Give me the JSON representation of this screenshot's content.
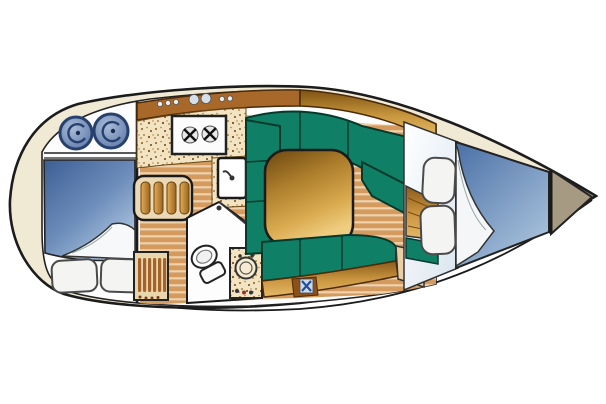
{
  "palette": {
    "page_bg": "#ffffff",
    "hull_outline": "#1c1c1c",
    "deck_cream": "#f0e9d4",
    "cabin_white": "#fdfdfd",
    "upholstery_green": "#0f8066",
    "upholstery_green_dark": "#06382c",
    "wood_gold": "#c8943e",
    "wood_brown": "#8a5a1a",
    "galley_strip_brown": "#a8682a",
    "counter_base": "#f2e4c2",
    "floor_tan": "#d59a5e",
    "floor_light": "#efd2ab",
    "berth_blue": "#4a70a6",
    "berth_blue_light": "#b6cbe2",
    "anchor_locker_taupe": "#a79a83",
    "louver_tan": "#e9d6ac",
    "louver_slat": "#a3632a",
    "fixture_blue": "#5b76a6",
    "fixture_navy": "#27406e",
    "pillow_white": "#f4f4f2",
    "stove_white": "#fcfcfc",
    "trim_tan": "#e8cfa4",
    "emblem_blue": "#1e4fa0"
  },
  "components": {
    "subject": "sailboat-interior-floorplan",
    "aft_cabin": {
      "pillow_count": 2,
      "swirl_fixture_count": 2
    },
    "galley": {
      "stove_burner_count": 2,
      "shelf_knob_count": 7,
      "locker_slat_count": 4
    },
    "head": {
      "toilet_count": 1,
      "vanity_sink_count": 1,
      "louver_slat_count": 6
    },
    "saloon": {
      "dinette_shape": "U",
      "table_count": 1,
      "aft_settee_count": 1
    },
    "v_berth": {
      "pillow_count": 2,
      "anchor_locker_count": 1
    }
  }
}
